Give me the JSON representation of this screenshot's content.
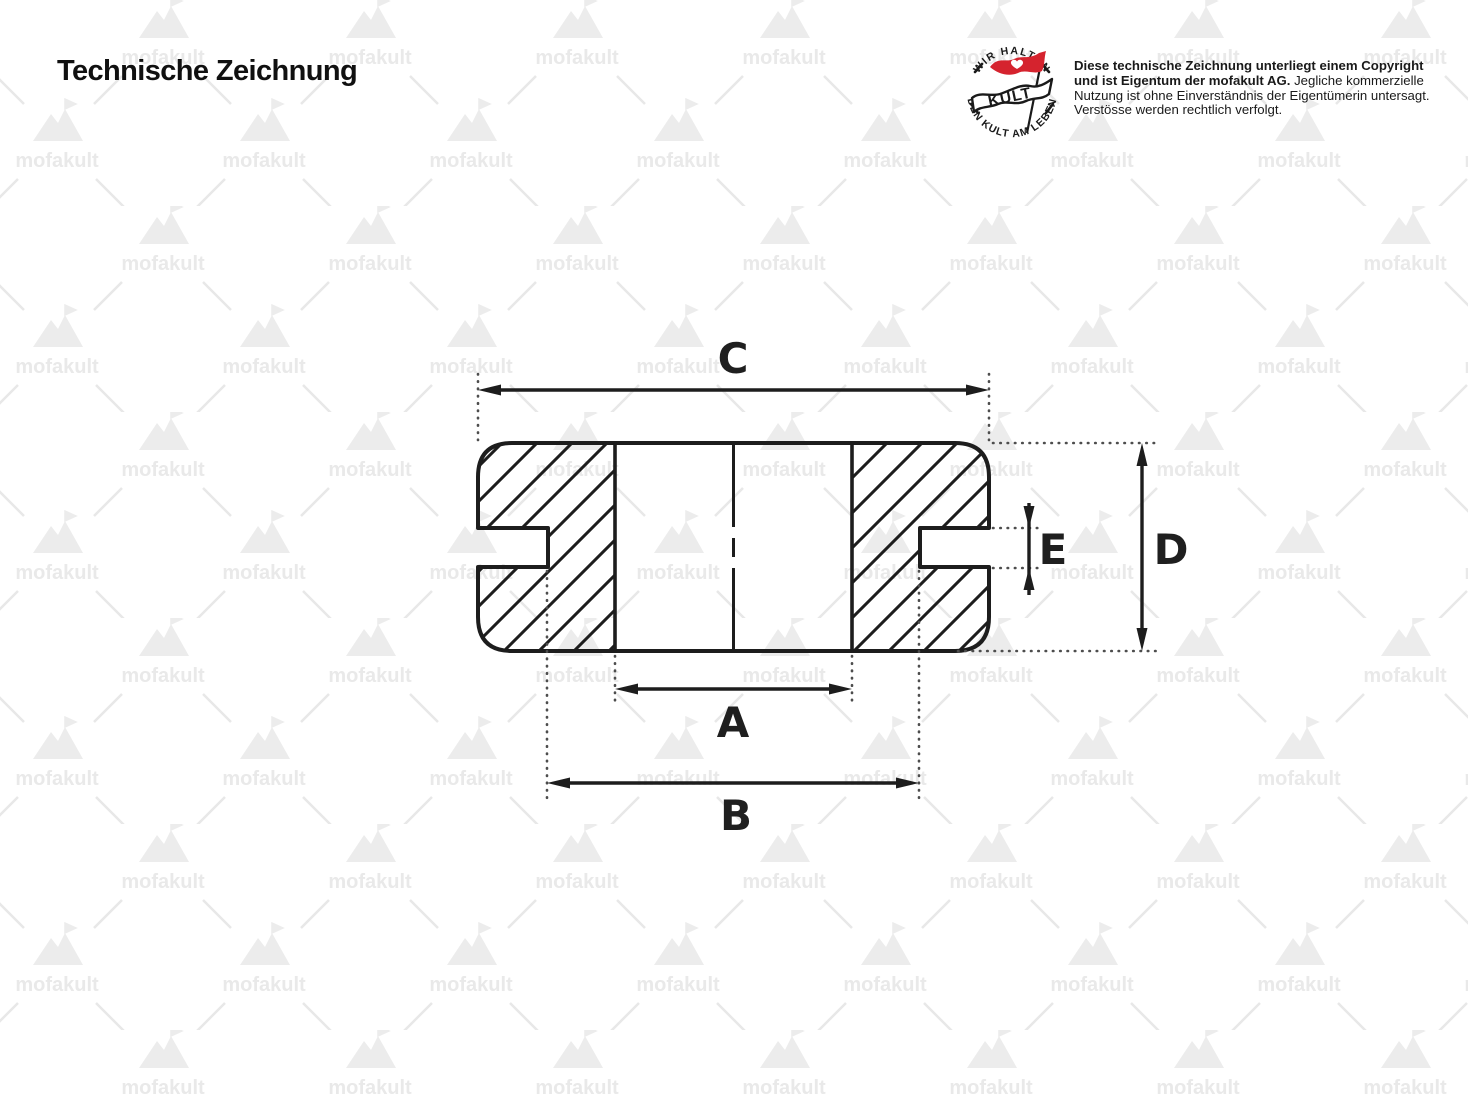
{
  "page": {
    "title": "Technische Zeichnung",
    "background_color": "#ffffff"
  },
  "badge": {
    "top_text": "WIR HALTEN",
    "bottom_text": "DEN KULT AM LEBEN",
    "center_text": "KULT",
    "flag_color": "#d5232e",
    "ink_color": "#1a1a1a"
  },
  "copyright": {
    "line1_bold": "Diese technische Zeichnung unterliegt einem Copyright",
    "line2_bold": "und ist Eigentum der mofakult AG.",
    "line2_regular": "Jegliche kommerzielle",
    "line3": "Nutzung ist ohne Einverständnis der Eigentümerin untersagt.",
    "line4": "Verstösse werden rechtlich verfolgt."
  },
  "watermark": {
    "text": "mofakult",
    "color": "#e9e9e9"
  },
  "drawing": {
    "type": "grommet-cross-section",
    "labels": {
      "a": "A",
      "b": "B",
      "c": "C",
      "d": "D",
      "e": "E"
    },
    "ink_color": "#1d1d1d",
    "extension_dot_color": "#4d4d4d"
  }
}
